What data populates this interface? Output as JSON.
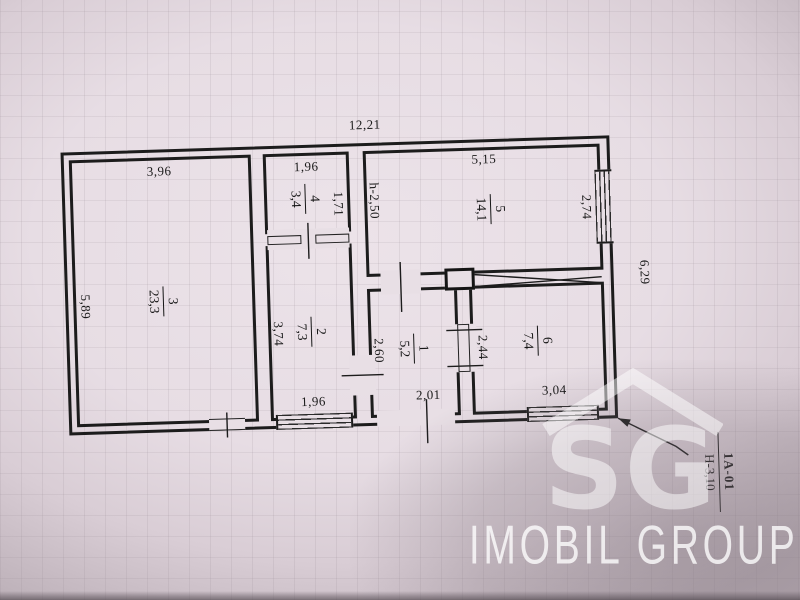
{
  "colors": {
    "ink": "#1c1c1c",
    "paper": "#e8dfe5"
  },
  "plan": {
    "dims": {
      "total_width": "12,21",
      "total_height": "6,29",
      "r3_width": "3,96",
      "r3_height": "5,89",
      "r4_width": "1,96",
      "r4_height": "1,71",
      "r2_height": "3,74",
      "r2_window": "1,96",
      "r5_width": "5,15",
      "r5_ceiling": "h-2,50",
      "r5_window": "2,74",
      "r1_height": "2,60",
      "r1_door": "2,01",
      "r6_height": "2,44",
      "r6_window": "3,04"
    },
    "rooms": {
      "r1": {
        "num": "1",
        "area": "5,2"
      },
      "r2": {
        "num": "2",
        "area": "7,3"
      },
      "r3": {
        "num": "3",
        "area": "23,3"
      },
      "r4": {
        "num": "4",
        "area": "3,4"
      },
      "r5": {
        "num": "5",
        "area": "14,1"
      },
      "r6": {
        "num": "6",
        "area": "7,4"
      }
    }
  },
  "annotation": {
    "ref": "1A-01",
    "height": "H-3,10"
  },
  "watermark": {
    "logo": "SG",
    "brand": "IMOBIL GROUP"
  }
}
